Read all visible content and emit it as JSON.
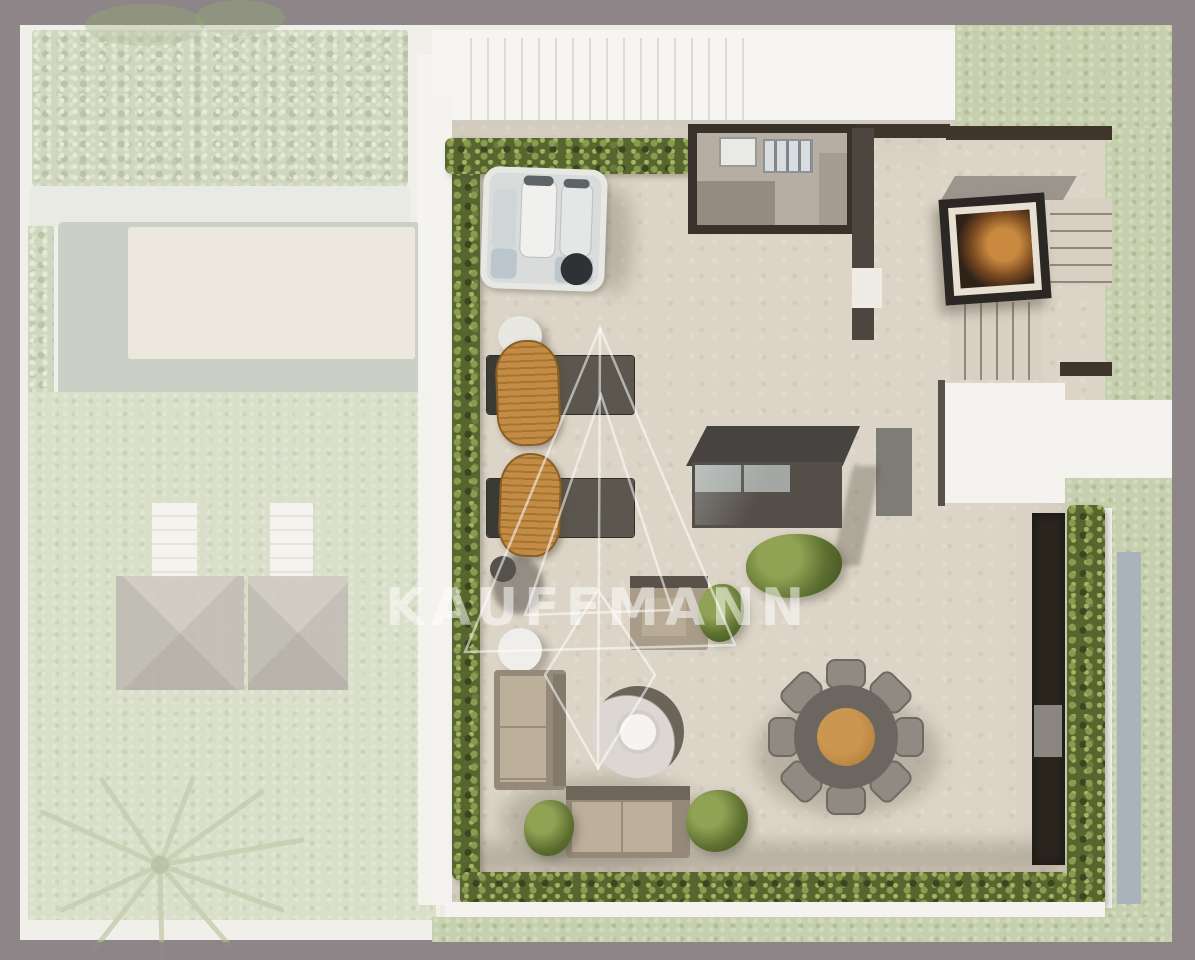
{
  "document": {
    "type": "architectural-site-plan",
    "view": "top-down rooftop terrace plan with faded garden context"
  },
  "watermark": {
    "text": "KAUFFMANN",
    "logo": "nested-triangle-monogram",
    "color": "rgba(255,255,255,0.52)"
  },
  "palette": {
    "frame_border": "#8d8588",
    "canvas": "#eeebe6",
    "terrace_floor": "#dcd5c7",
    "hedge_green": "#57652f",
    "lawn_faded": "#c7d0ae",
    "wicker_tan": "#c08a44",
    "wood_beam": "#40352a",
    "charcoal_structure": "#39322b",
    "glass_blue_strip": "#aab3bc",
    "fire_orange": "#b97a33",
    "white_structure": "#f4f3ef",
    "pool_water": "#aeb9ab"
  },
  "scene_inventory": {
    "faded_garden": [
      "planting-bed",
      "pool",
      "pool-deck",
      "garden-path",
      "lawn",
      "sun-deck-steps",
      "pavilion-roofs",
      "palm-tree"
    ],
    "terrace": [
      "privacy-hedges",
      "hot-tub",
      "outdoor-kitchen",
      "fireplace",
      "stair-treads",
      "stair-landing",
      "roof-walkway",
      "skylight",
      "sun-loungers",
      "wicker-chairs",
      "side-table",
      "pouf",
      "sofas",
      "fire-pit",
      "ottoman",
      "round-dining-table",
      "dining-chairs",
      "planter-bushes",
      "dark-walkway",
      "glass-strip"
    ]
  }
}
